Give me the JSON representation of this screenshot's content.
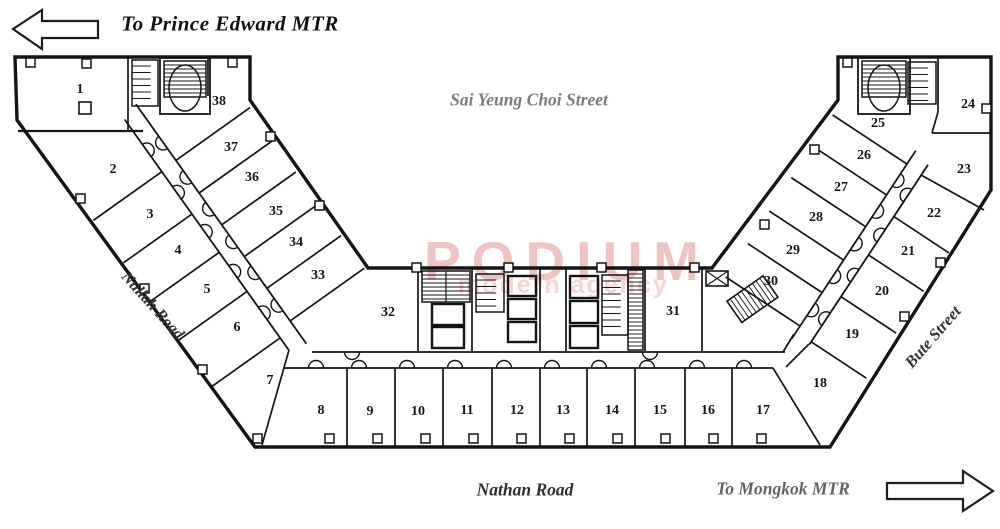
{
  "labels": {
    "to_prince_edward": "To Prince Edward MTR",
    "sai_yeung_choi_street": "Sai Yeung Choi Street",
    "nullah_road": "Nullah Road",
    "bute_street": "Bute Street",
    "nathan_road": "Nathan Road",
    "to_mongkok": "To Mongkok MTR"
  },
  "watermark": {
    "line1": "PODIUM",
    "line2": "modern agency"
  },
  "units": [
    "1",
    "2",
    "3",
    "4",
    "5",
    "6",
    "7",
    "8",
    "9",
    "10",
    "11",
    "12",
    "13",
    "14",
    "15",
    "16",
    "17",
    "18",
    "19",
    "20",
    "21",
    "22",
    "23",
    "24",
    "25",
    "26",
    "27",
    "28",
    "29",
    "30",
    "31",
    "32",
    "33",
    "34",
    "35",
    "36",
    "37",
    "38"
  ],
  "icons": {
    "arrow_left": "left-direction-arrow",
    "arrow_right": "right-direction-arrow"
  },
  "colors": {
    "line": "#141414",
    "watermark1": "#ecafaf",
    "watermark2": "#f4cdcd",
    "street_gray": "#7b7b7b"
  }
}
